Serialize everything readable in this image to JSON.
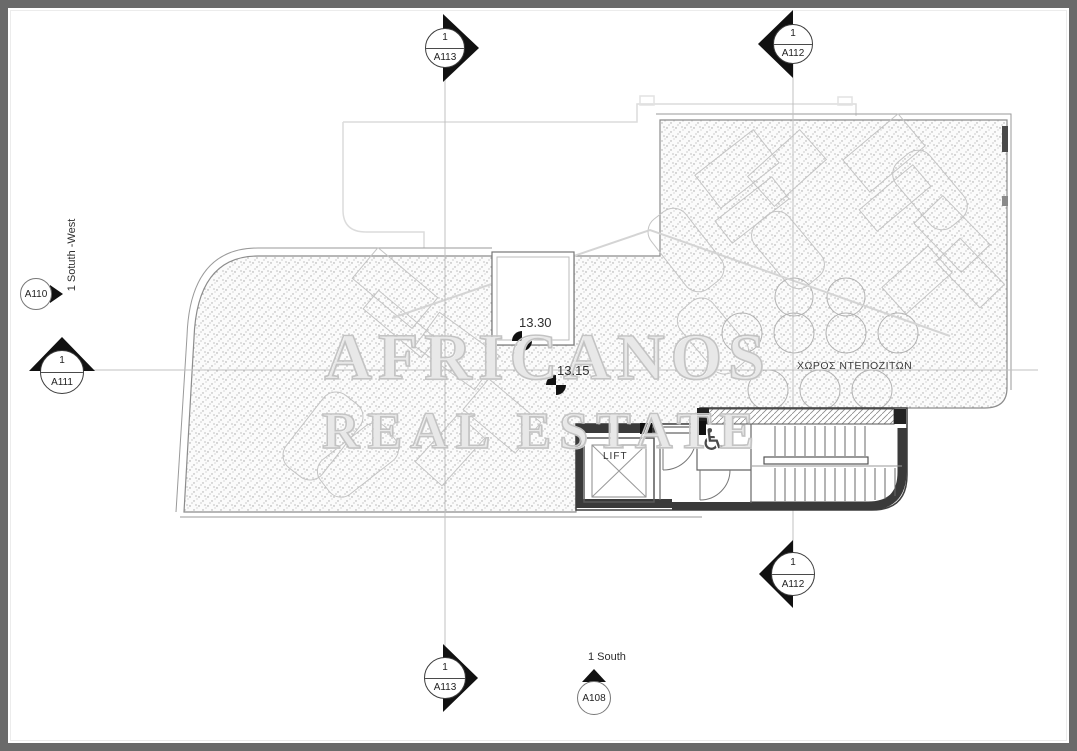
{
  "plan": {
    "levels": {
      "upper": "13.30",
      "lower": "13.15"
    },
    "rooms": {
      "lift": "LIFT",
      "deposit": "ΧΩΡΟΣ ΝΤΕΠΟΖΙΤΩΝ"
    },
    "annotations": {
      "south_west": "1  Sotuth -West",
      "south": "1 South"
    }
  },
  "markers": {
    "top_a113": {
      "number": "1",
      "sheet": "A113"
    },
    "top_a112": {
      "number": "1",
      "sheet": "A112"
    },
    "a110": {
      "sheet": "A110"
    },
    "a111": {
      "number": "1",
      "sheet": "A111"
    },
    "bottom_a112": {
      "number": "1",
      "sheet": "A112"
    },
    "bottom_a113": {
      "number": "1",
      "sheet": "A113"
    },
    "a108": {
      "sheet": "A108"
    }
  },
  "watermark": {
    "line1": "AFRICANOS",
    "line2": "REAL ESTATE"
  },
  "icons": {
    "wheelchair": "♿"
  },
  "colors": {
    "frame": "#6a6a6a",
    "walls": "#3a3a3a",
    "stipple_dot": "#a0a0a0",
    "grid_line": "#c0c0c0",
    "faint_outline": "#c6c6c6",
    "watermark": "#c3c3c3",
    "text": "#2e2e2e"
  }
}
